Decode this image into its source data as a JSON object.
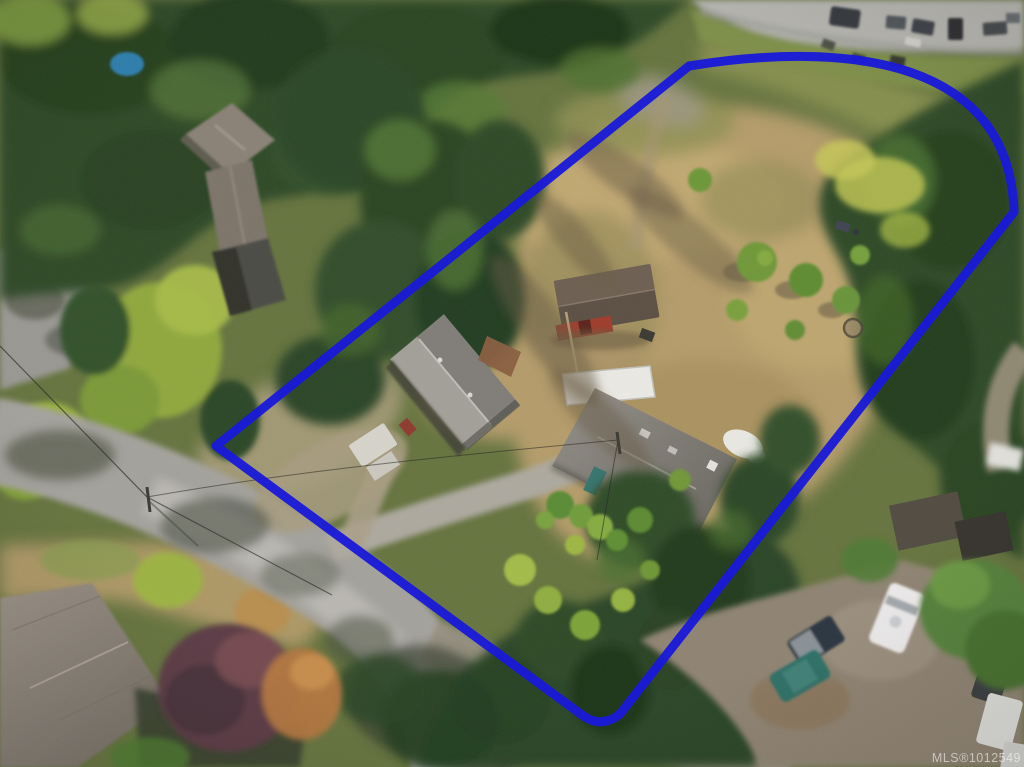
{
  "page": {
    "title": "Aerial property photo with lot line overlay"
  },
  "watermark": {
    "text": "MLS®1012549"
  },
  "boundary": {
    "color": "#1a1ad8",
    "stroke_width": "9",
    "path": "M 216 446 L 689 66 C 850 40 1010 60 1014 212 L 620 714 Q 601 729 582 715 Z"
  },
  "scene": {
    "description": "Aerial drone view of a treed rural lot: main house, garage, red barn-shed, dry field with scattered fruit trees, roads, neighbouring homes and parked vehicles",
    "features": [
      {
        "name": "property-boundary",
        "color": "#1a1ad8"
      },
      {
        "name": "main-house-roof",
        "color": "#7d7973"
      },
      {
        "name": "carport-white-roof",
        "color": "#ebeae5"
      },
      {
        "name": "garage-roof",
        "color": "#96938e"
      },
      {
        "name": "barn-shed-roof",
        "color": "#5c4f44"
      },
      {
        "name": "barn-shed-red-wall",
        "color": "#a03c2c"
      },
      {
        "name": "dry-field",
        "color": "#b59c6b"
      },
      {
        "name": "conifer-forest",
        "color": "#2e4927"
      },
      {
        "name": "asphalt-road",
        "color": "#a4a29c"
      },
      {
        "name": "white-truck",
        "color": "#eceaea"
      },
      {
        "name": "teal-suv",
        "color": "#2f6f66"
      },
      {
        "name": "purple-leaf-tree",
        "color": "#5c3a45"
      },
      {
        "name": "orange-tree",
        "color": "#b3763f"
      },
      {
        "name": "swimming-pool",
        "color": "#2f7fae"
      }
    ]
  }
}
